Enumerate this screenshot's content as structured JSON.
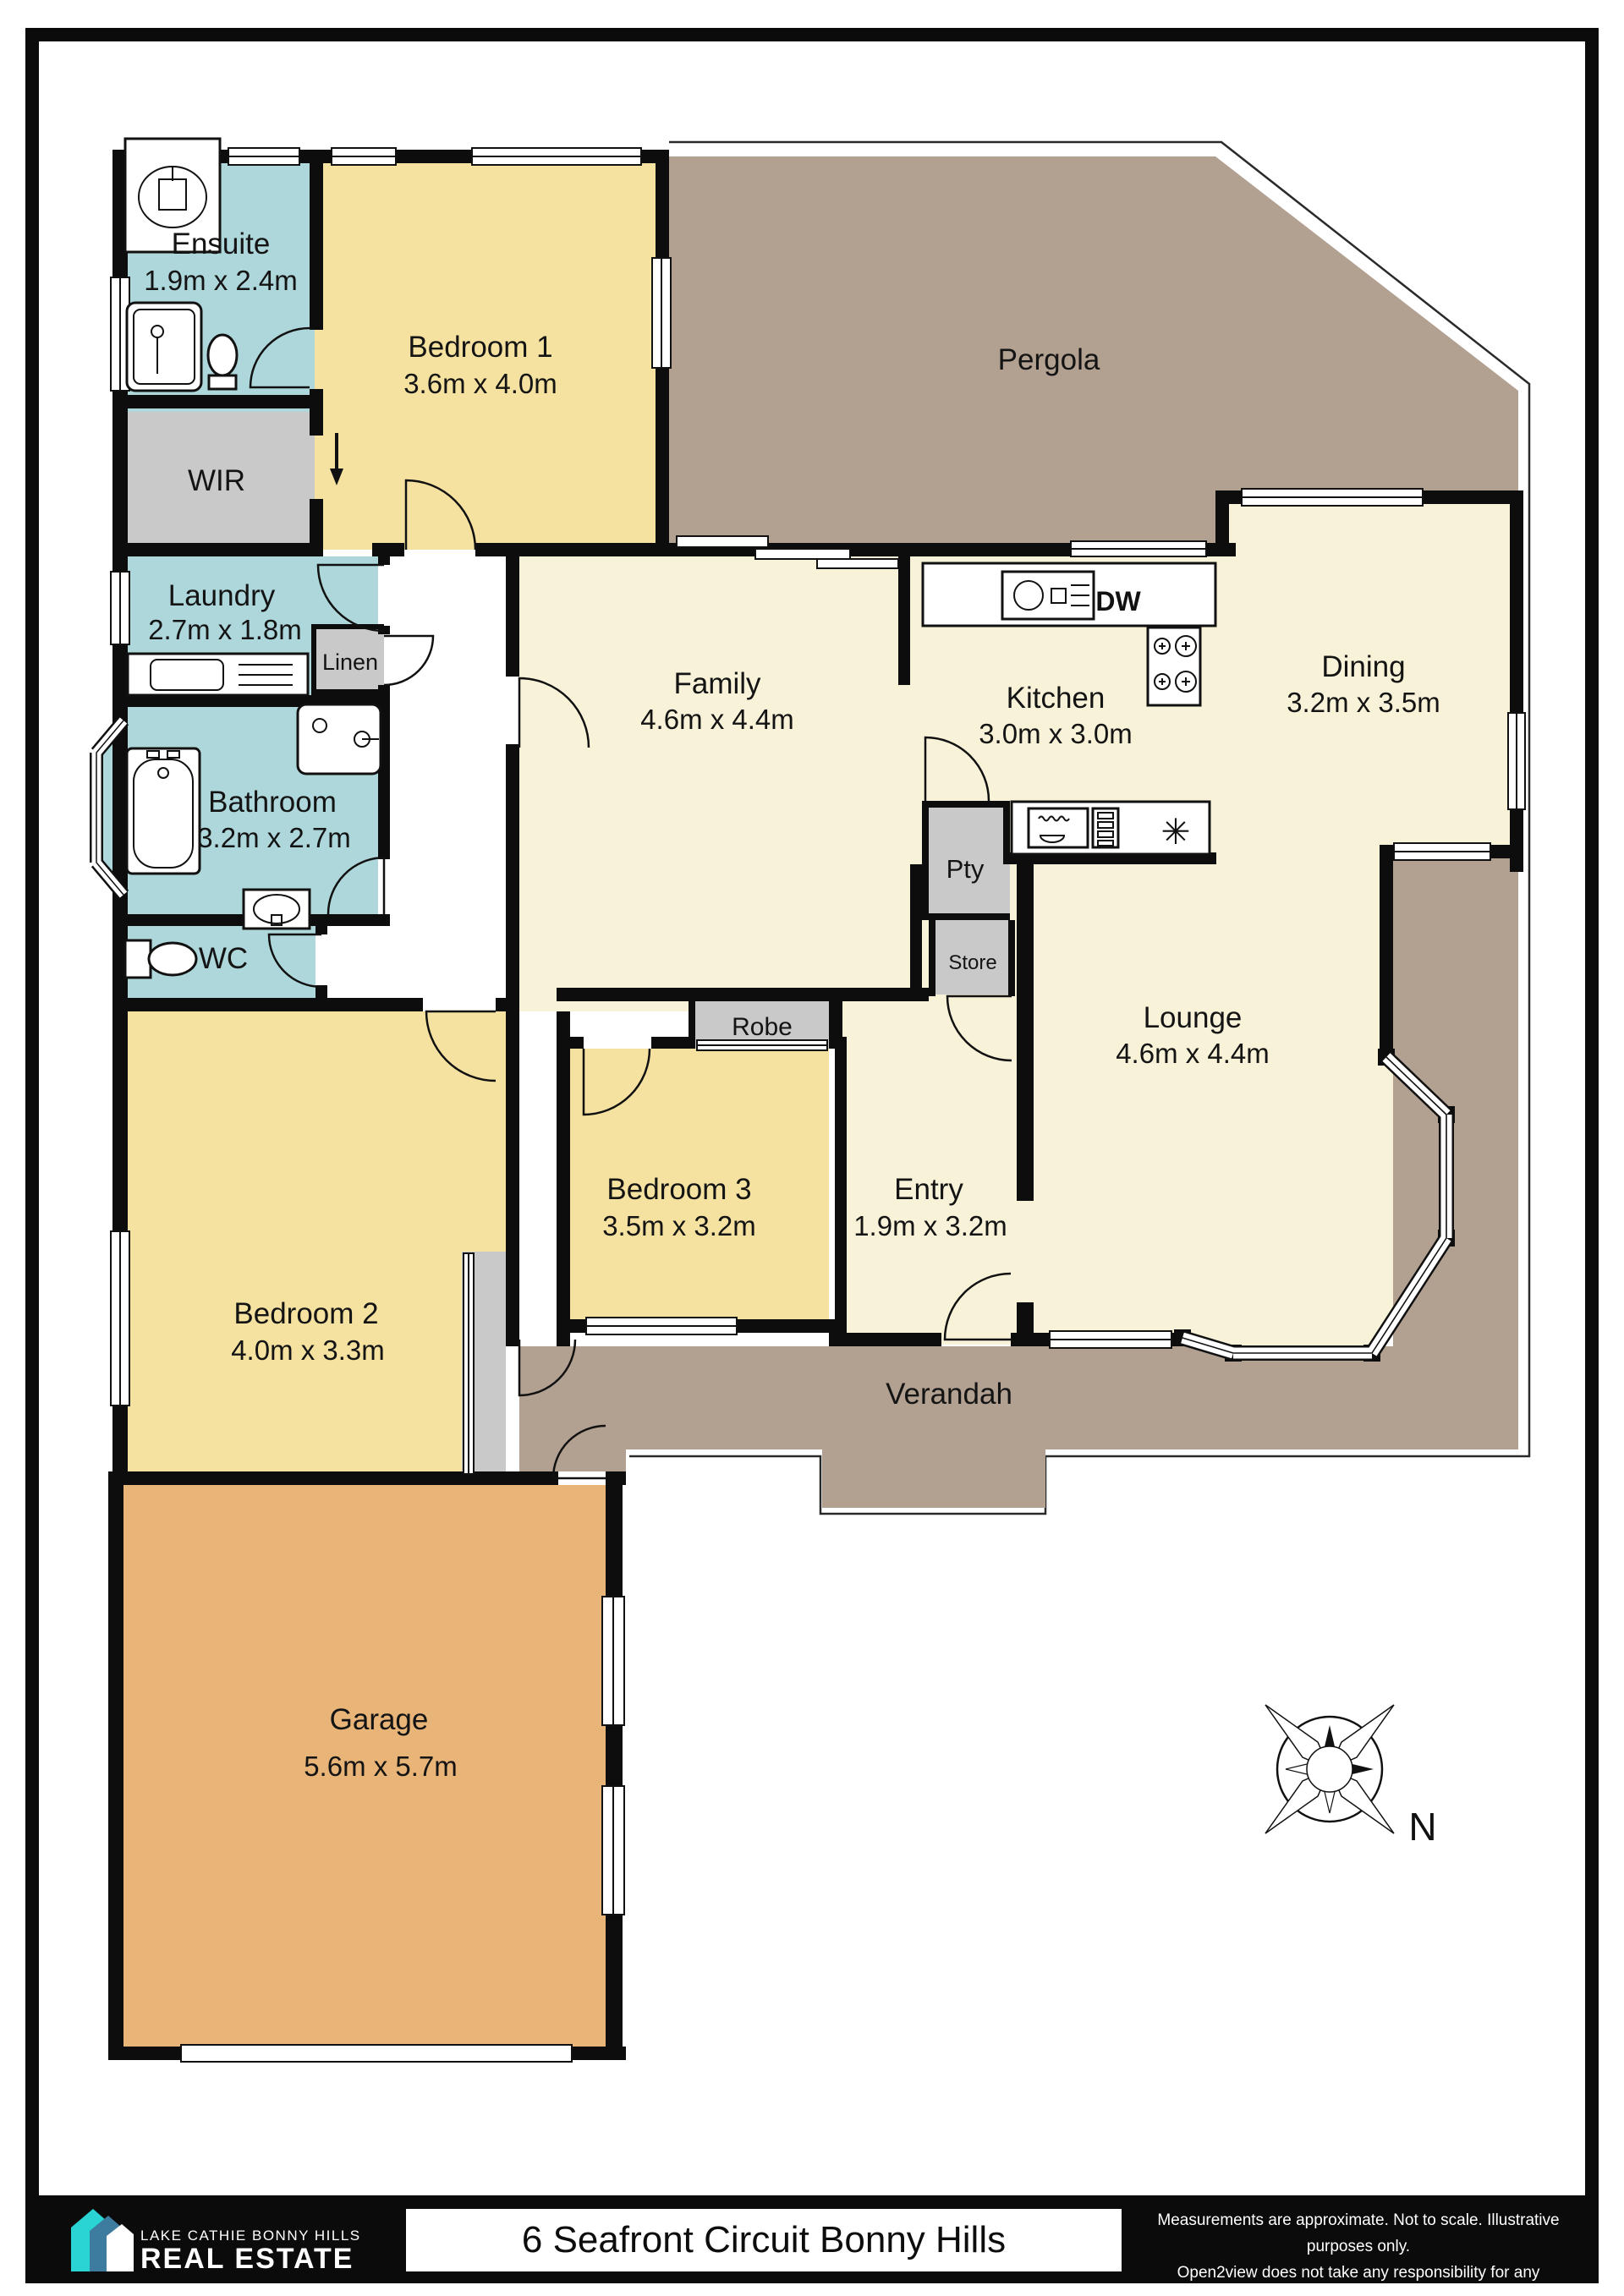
{
  "address_bar": {
    "address": "6 Seafront Circuit Bonny Hills"
  },
  "branding": {
    "line1": "LAKE CATHIE BONNY HILLS",
    "line2": "REAL ESTATE"
  },
  "disclaimer": {
    "line1": "Measurements are approximate. Not to scale. Illustrative purposes only.",
    "line2": "Open2view does not take any responsibility for any information supplied"
  },
  "compass": {
    "north_label": "N"
  },
  "appliances": {
    "dishwasher_label": "DW",
    "star_symbol": "✳"
  },
  "rooms": {
    "ensuite": {
      "name": "Ensuite",
      "dims": "1.9m x 2.4m"
    },
    "bedroom1": {
      "name": "Bedroom 1",
      "dims": "3.6m x 4.0m"
    },
    "wir": {
      "name": "WIR"
    },
    "pergola": {
      "name": "Pergola"
    },
    "laundry": {
      "name": "Laundry",
      "dims": "2.7m x 1.8m"
    },
    "linen": {
      "name": "Linen"
    },
    "family": {
      "name": "Family",
      "dims": "4.6m x 4.4m"
    },
    "kitchen": {
      "name": "Kitchen",
      "dims": "3.0m x 3.0m"
    },
    "dining": {
      "name": "Dining",
      "dims": "3.2m x 3.5m"
    },
    "bathroom": {
      "name": "Bathroom",
      "dims": "3.2m x 2.7m"
    },
    "pantry": {
      "name": "Pty"
    },
    "store": {
      "name": "Store"
    },
    "robe": {
      "name": "Robe"
    },
    "wc": {
      "name": "WC"
    },
    "bedroom3": {
      "name": "Bedroom 3",
      "dims": "3.5m x 3.2m"
    },
    "entry": {
      "name": "Entry",
      "dims": "1.9m x 3.2m"
    },
    "lounge": {
      "name": "Lounge",
      "dims": "4.6m x 4.4m"
    },
    "bedroom2": {
      "name": "Bedroom 2",
      "dims": "4.0m x 3.3m"
    },
    "verandah": {
      "name": "Verandah"
    },
    "garage": {
      "name": "Garage",
      "dims": "5.6m x 5.7m"
    }
  },
  "colors": {
    "wet": "#aed7db",
    "bedroom": "#f5e2a1",
    "living": "#f8f2d8",
    "outdoor": "#b2a091",
    "garage": "#e9b478",
    "storage": "#c9c9c9",
    "wall": "#0d0d0d",
    "accent_cyan": "#2bd4d4",
    "accent_blue": "#3d7c9f"
  }
}
